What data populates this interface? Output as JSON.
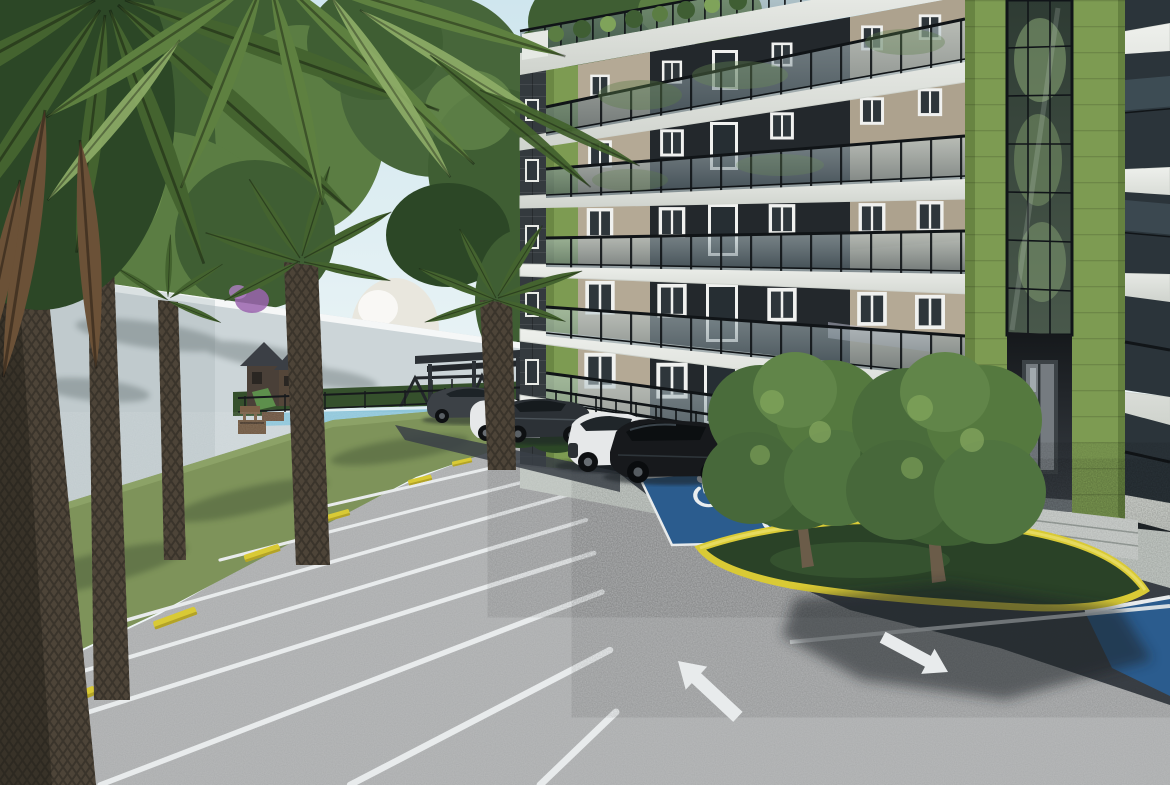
{
  "scene": {
    "domain": "architectural-3d-render",
    "description": "Daytime photorealistic 3D rendering of a modern six-story apartment building with olive-green accent piers, charcoal and beige facade panels and glass balcony railings, seen from its parking lot. A white perimeter wall lined with tall palm trees runs along the left, a swimming pool, playground gazebos and a pergola sit in the background, five cars are parked nose-in at the building, two blue accessible parking stalls with white wheelchair symbols adjoin a yellow-curbed grass island planted with two round trees, and white directional arrows and stall lines are painted on the asphalt.",
    "time_of_day": "day",
    "no_visible_text": true
  },
  "palette": {
    "skyTop": "#cfe6ee",
    "skyLow": "#eef6f7",
    "canopyDark": "#2c4726",
    "canopyMid": "#3f5e33",
    "canopyLight": "#5b7d43",
    "canopyHighlight": "#7fa35a",
    "wall": "#ccd5d8",
    "wallShadow": "#a9b6ba",
    "grass": "#7e935a",
    "grassDark": "#5a7140",
    "hedge": "#35502c",
    "pool": "#8fc6da",
    "structureDark": "#2e3338",
    "asphalt": "#a9abac",
    "asphaltDark": "#3a4046",
    "lineWhite": "#e8ebec",
    "parkingBlue": "#2b5c8e",
    "curbYellow": "#d9ca35",
    "curbYellowDark": "#ac9c24",
    "gravel": "#c8cec9",
    "slab": "#eef0ec",
    "slabShade": "#cfd3cd",
    "beige": "#b4a995",
    "beigeDark": "#a39884",
    "panelDark": "#23282c",
    "accentGreen": "#7d9b52",
    "accentGreenDark": "#5f7a3c",
    "glassDark": "#2b343a",
    "railBlack": "#101417",
    "carWhite": "#e6e8e9",
    "carGray": "#3c4146",
    "carGraphite": "#2c3136",
    "carBlack": "#17191c",
    "trunkBrown": "#4d4438",
    "trunkDark": "#2f2a22",
    "palmGreen": "#44632f",
    "palmBrown": "#6b5137",
    "blossom": "#e9e6dc",
    "bougainvillea": "#9a64ae",
    "doorGlass": "#757b80",
    "shadow": "#1c2125",
    "islandGrass": "#2a4227"
  },
  "building": {
    "floors_visible": 6,
    "balcony_railing": "framed glass with black posts",
    "facade_materials": [
      "white concrete slabs",
      "charcoal panels",
      "beige stucco",
      "olive-green accent piers",
      "glass stair tower"
    ],
    "features": [
      "rooftop terrace planting",
      "recessed lobby entrance with glass door",
      "ground-floor storefront glazing",
      "black metal guard fence"
    ]
  },
  "parking": {
    "accessible_spaces": 3,
    "wheelchair_symbols": 2,
    "direction_arrows": 2,
    "wheel_stop_color": "yellow",
    "stall_line_color": "white",
    "surface": [
      "light weathered asphalt",
      "dark fresh asphalt"
    ]
  },
  "vehicles": [
    {
      "type": "sedan",
      "color": "dark gray"
    },
    {
      "type": "sedan",
      "color": "white"
    },
    {
      "type": "hatchback",
      "color": "graphite"
    },
    {
      "type": "suv",
      "color": "white"
    },
    {
      "type": "suv",
      "color": "black"
    }
  ],
  "vegetation": {
    "palm_trees": 5,
    "round_trees_on_island": 2,
    "background": [
      "pine canopy",
      "white blossom tree",
      "bougainvillea",
      "hedge row",
      "rooftop plants"
    ]
  },
  "amenities": [
    "swimming pool",
    "playground gazebos",
    "pergola",
    "swing set",
    "picnic tables"
  ]
}
